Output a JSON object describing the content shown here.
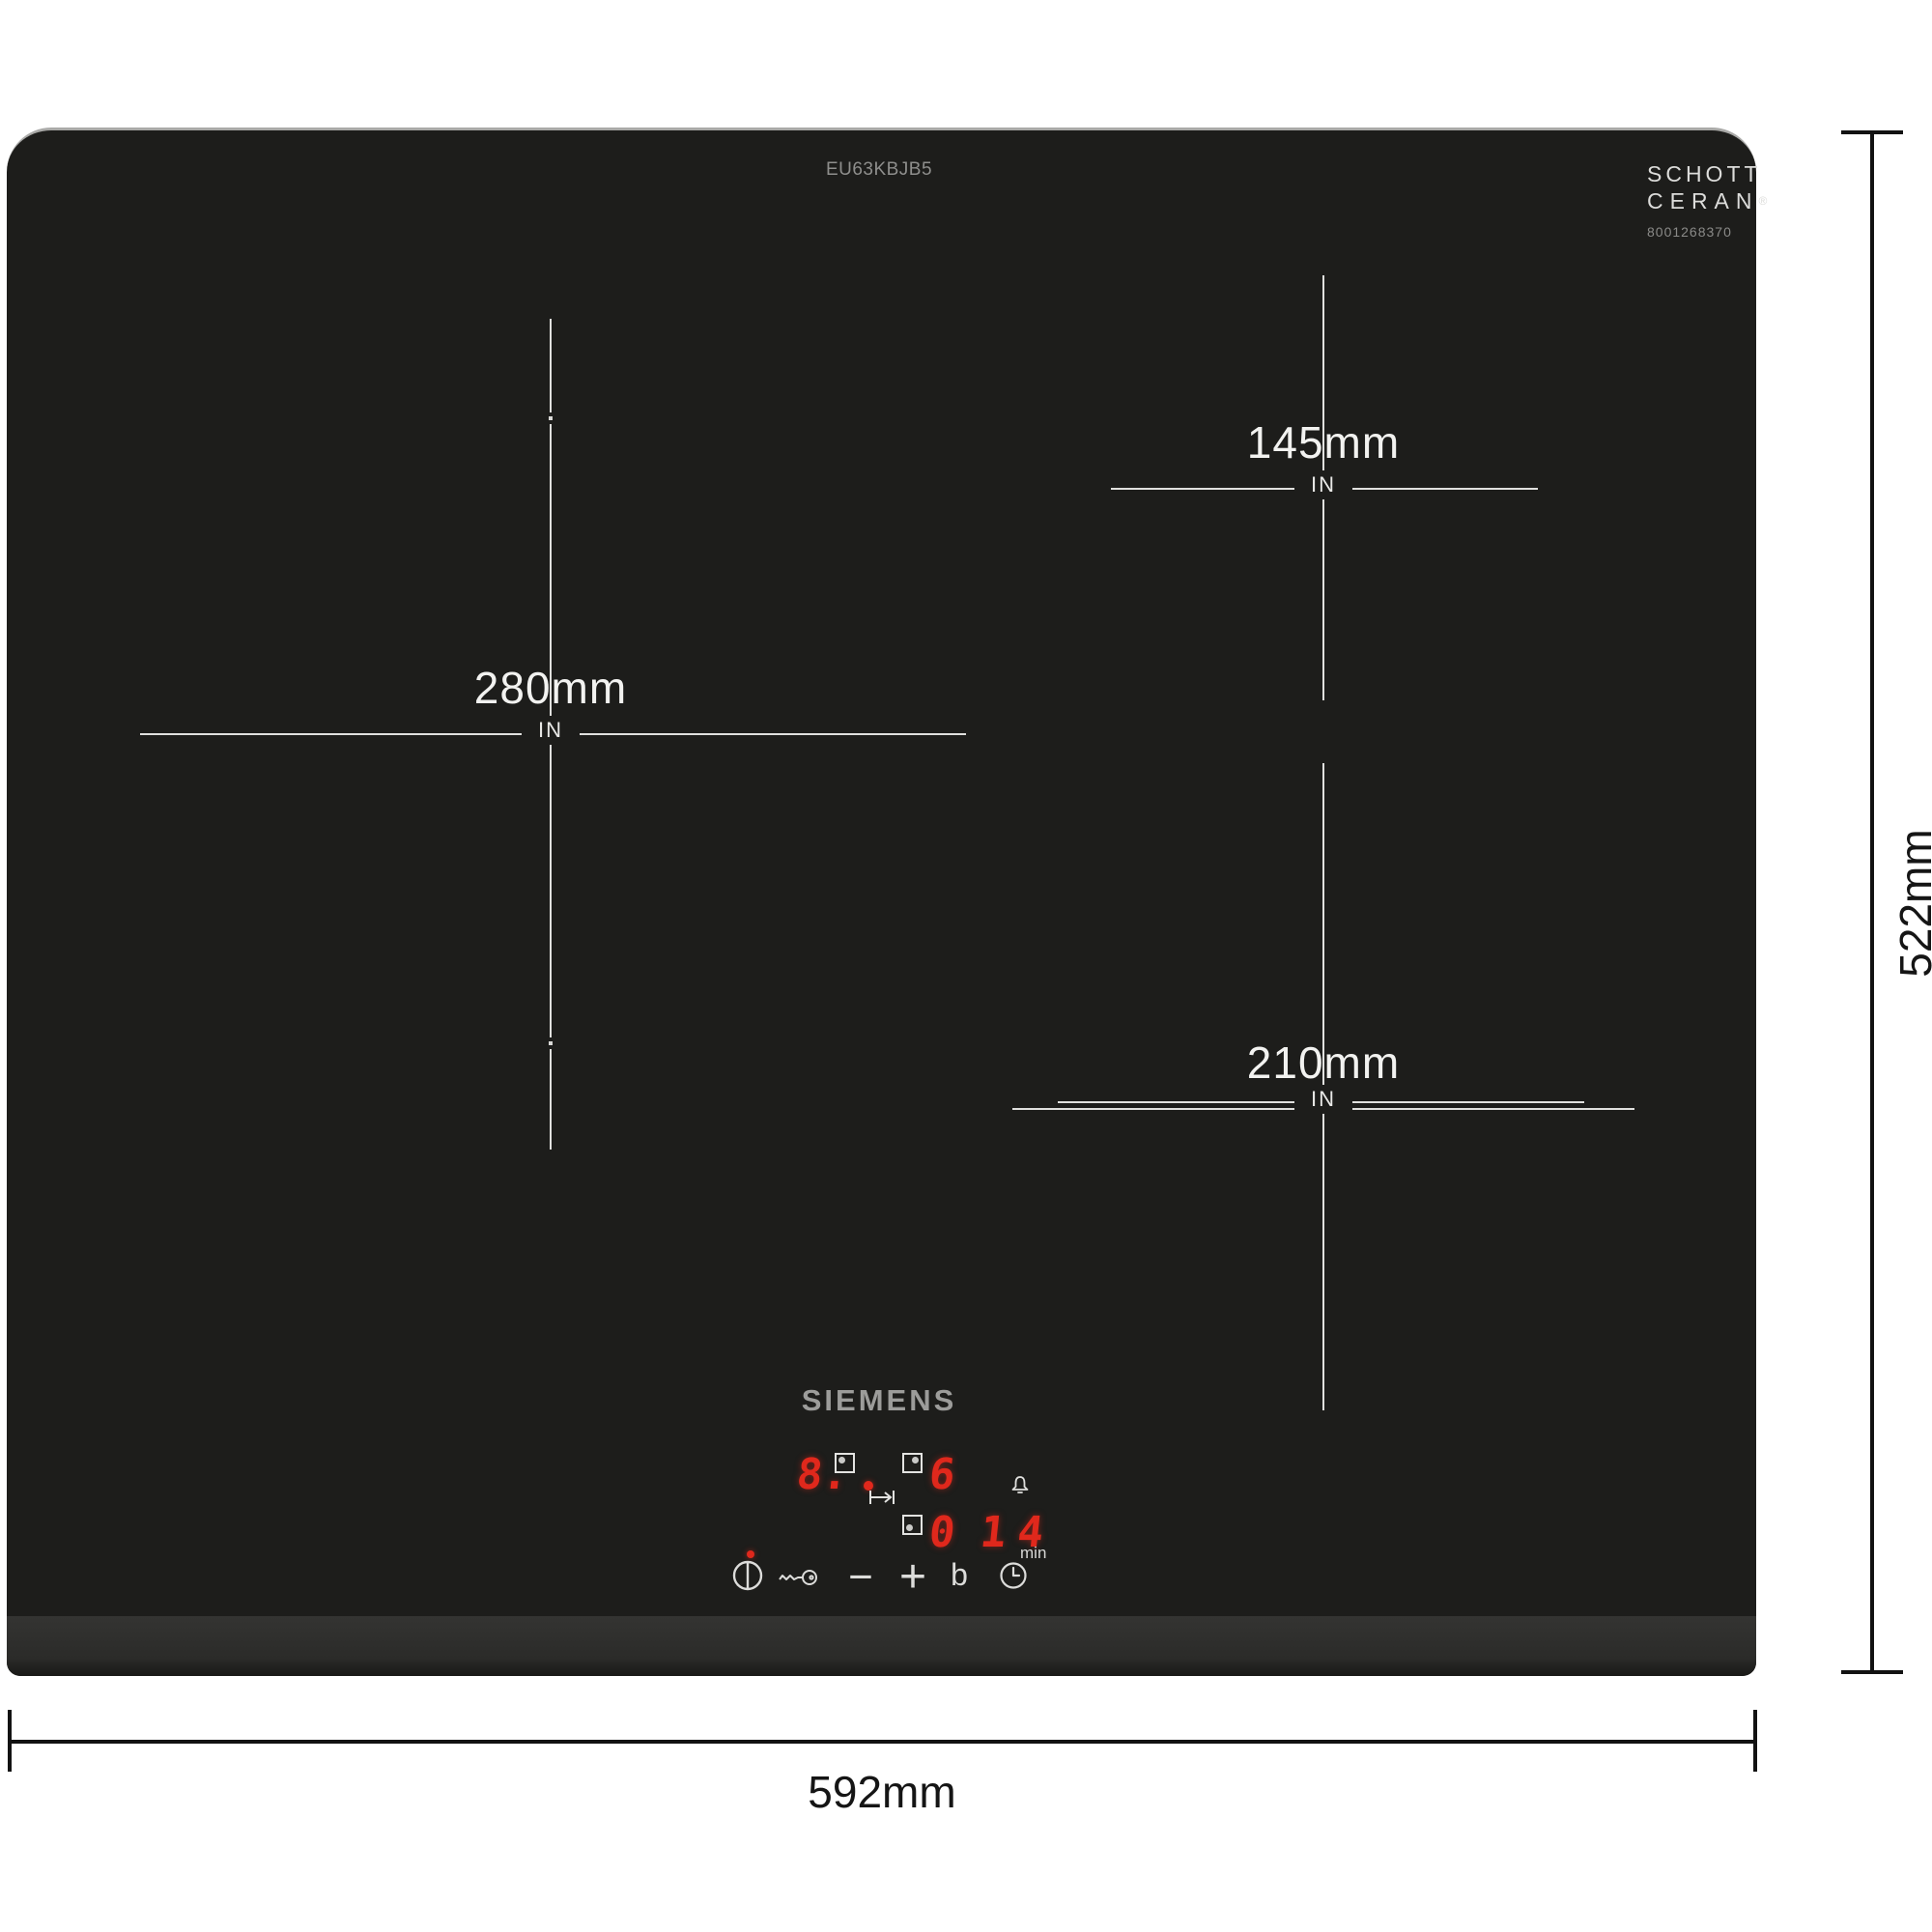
{
  "product": {
    "model_number": "EU63KBJB5",
    "brand_logo": "SIEMENS",
    "glass_logo": {
      "line1": "SCHOTT",
      "line2": "CERAN",
      "registered": "®",
      "serial": "8001268370"
    }
  },
  "zones": [
    {
      "name": "left",
      "diameter": "280mm",
      "unit_marker": "IN"
    },
    {
      "name": "right-back",
      "diameter": "145mm",
      "unit_marker": "IN"
    },
    {
      "name": "right-front",
      "diameter": "210mm",
      "unit_marker": "IN"
    }
  ],
  "overall_dimensions": {
    "width": "592mm",
    "depth": "522mm"
  },
  "control_panel": {
    "zone1_level": "8.",
    "zone2_level": "6",
    "zone3_level": "0",
    "timer_value": "14",
    "timer_unit": "min",
    "minus_label": "−",
    "plus_label": "+",
    "boost_label": "b"
  },
  "icons": {
    "power": "power-icon",
    "child_lock": "key-icon",
    "timer": "clock-icon",
    "alarm": "bell-icon",
    "pan_move": "pan-move-arrow-icon",
    "zone_indicator": "square-dot-icon"
  },
  "colors": {
    "hob_surface": "#1d1d1b",
    "led_red": "#e0281c",
    "marking_white": "#efefed",
    "dimension_black": "#111111"
  }
}
